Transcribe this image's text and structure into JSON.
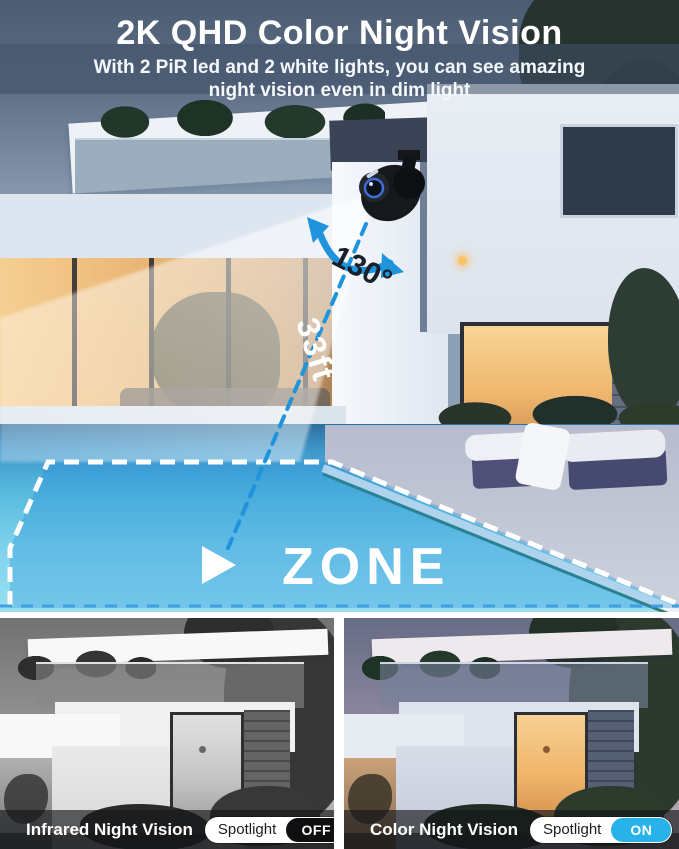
{
  "header": {
    "title": "2K QHD Color Night Vision",
    "subtitle_line1": "With 2 PiR led and 2 white lights, you can see amazing",
    "subtitle_line2": "night vision even in dim light"
  },
  "scene": {
    "angle_label": "130°",
    "distance_label": "33ft",
    "zone_label": "ZONE"
  },
  "colors": {
    "accent_blue": "#1f94dc",
    "zone_tint": "rgba(32,140,214,0.30)",
    "toggle_on": "#29b2e9",
    "toggle_off": "#0f0f12"
  },
  "panels": [
    {
      "label": "Infrared Night Vision",
      "toggle_label": "Spotlight",
      "toggle_state": "OFF"
    },
    {
      "label": "Color Night Vision",
      "toggle_label": "Spotlight",
      "toggle_state": "ON"
    }
  ]
}
